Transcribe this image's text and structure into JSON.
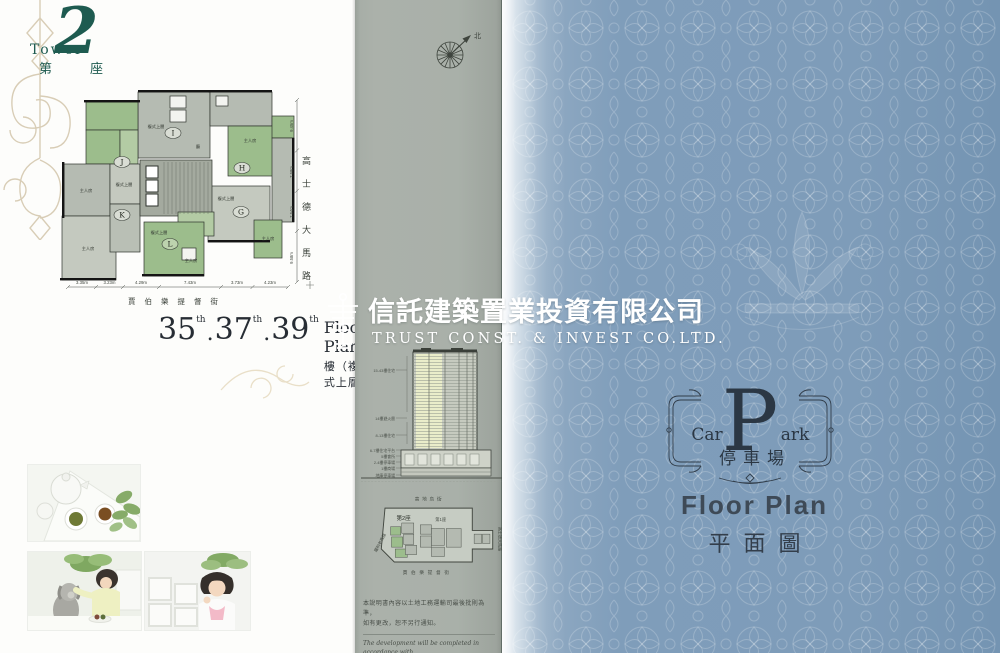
{
  "colors": {
    "teal": "#1e5b50",
    "panel_gray": "#a9b0a9",
    "cover_blue": "#7e9cba",
    "unit_green": "#9cbd8c",
    "logo_navy": "#2b3744"
  },
  "left_page": {
    "tower_badge": {
      "en": "Tower",
      "number": "2",
      "zh_first": "第",
      "zh_last": "座"
    },
    "floorplan": {
      "units": {
        "i": "I",
        "j": "J",
        "h": "H",
        "k": "K",
        "g": "G",
        "l": "L"
      },
      "rooms": {
        "master": "主人房",
        "duplex": "複式上層",
        "living": "廳"
      },
      "dims_bottom": [
        "3.35m",
        "3.23m",
        "4.29m",
        "7.43m",
        "3.73m",
        "4.23m"
      ],
      "dims_right": [
        "9.45m",
        "7.58m",
        "7.54m",
        "9.58m"
      ],
      "street_bottom": "賈伯樂提督街",
      "street_right": "高士德大馬路"
    },
    "caption": {
      "n1": "35",
      "n2": "37",
      "n3": "39",
      "sup": "th",
      "sep": ".",
      "en": "Floor Plan",
      "zh": "樓（複式上層）"
    }
  },
  "banner": {
    "company_zh": "信託建築置業投資有限公司",
    "company_en": "TRUST  CONST.  &  INVEST  CO.LTD."
  },
  "middle_panel": {
    "compass_north": "北",
    "elevation_labels": [
      "15-43樓住宅",
      "14樓避火層",
      "8-13樓住宅",
      "6-7樓住宅平台",
      "5樓會所",
      "2-4樓停車場",
      "1樓商場",
      "地庫停車場"
    ],
    "site_plan": {
      "street_top": "高地烏街",
      "street_left": "羅利老馬路",
      "street_right": "高士德大馬路",
      "street_bottom": "賈伯樂提督街",
      "tower2": "第2座",
      "tower1": "第1座"
    },
    "disclaimer_zh1": "本說明書內容以土地工務運輸司最後批則為準，",
    "disclaimer_zh2": "如有更改，恕不另行通知。",
    "disclaimer_en1": "The development will be completed in accordance with",
    "disclaimer_en2": "the final plans approved by the building authorities and",
    "disclaimer_en3": "subject to the change without prior notice."
  },
  "cover": {
    "emblem": {
      "car": "Car",
      "initial": "P",
      "ark": "ark",
      "zh": "停車場"
    },
    "floor_plan_en": "Floor Plan",
    "floor_plan_zh": "平面圖"
  }
}
